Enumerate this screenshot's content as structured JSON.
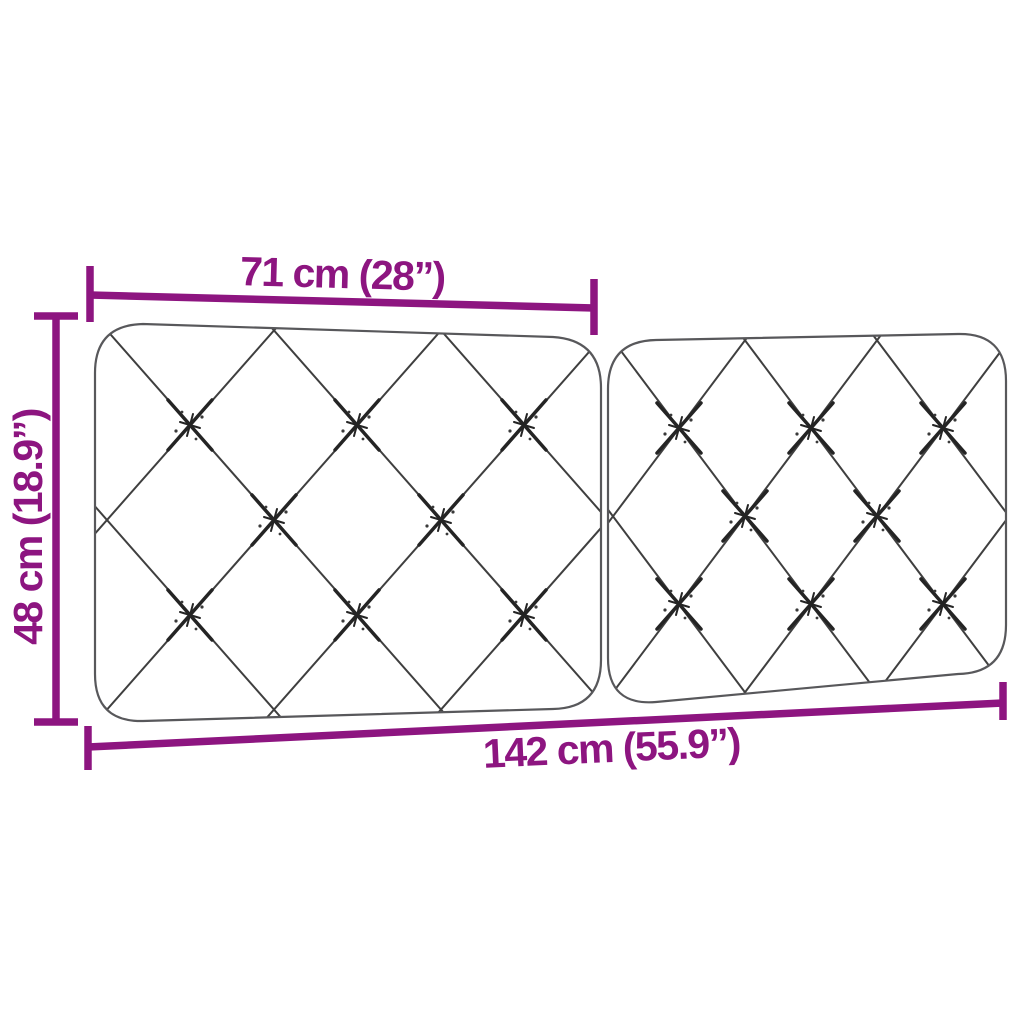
{
  "diagram": {
    "description": "Two-panel diamond-tufted headboard cushion dimension diagram",
    "style": {
      "dimension_color": "#8d1580",
      "outline_color": "#58585b",
      "tufting_color": "#3f3f3f",
      "button_color": "#242424",
      "background": "#ffffff"
    },
    "dimensions": {
      "top_width": {
        "label": "71 cm (28”)",
        "cm": "71",
        "inches": "28"
      },
      "height": {
        "label": "48 cm (18.9”)",
        "cm": "48",
        "inches": "18.9"
      },
      "total_width": {
        "label": "142 cm (55.9”)",
        "cm": "142",
        "inches": "55.9"
      }
    },
    "cushion": {
      "panel_count": 2,
      "pattern": "diamond-tufted",
      "buttons_per_panel": 8
    }
  }
}
